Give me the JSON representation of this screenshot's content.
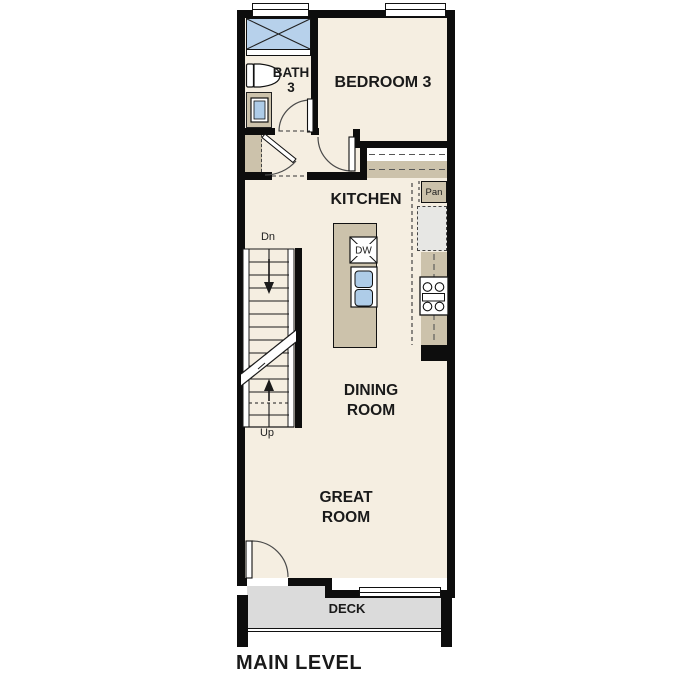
{
  "plan_title": "MAIN LEVEL",
  "rooms": {
    "bath": {
      "name_line1": "BATH",
      "name_line2": "3"
    },
    "bedroom": {
      "name": "BEDROOM 3"
    },
    "kitchen": {
      "name": "KITCHEN"
    },
    "dining": {
      "name_line1": "DINING",
      "name_line2": "ROOM"
    },
    "great": {
      "name_line1": "GREAT",
      "name_line2": "ROOM"
    },
    "deck": {
      "name": "DECK"
    }
  },
  "fixtures": {
    "pantry": "Pan",
    "dishwasher": "DW"
  },
  "stairs": {
    "down_label": "Dn",
    "up_label": "Up"
  },
  "colors": {
    "wall": "#0d0d0d",
    "floor": "#f5eee1",
    "counter": "#ccc2ab",
    "shower": "#b7d1eb",
    "sink": "#aecce8",
    "deck": "#dbdbdb",
    "appliance": "#e7e7e4"
  }
}
